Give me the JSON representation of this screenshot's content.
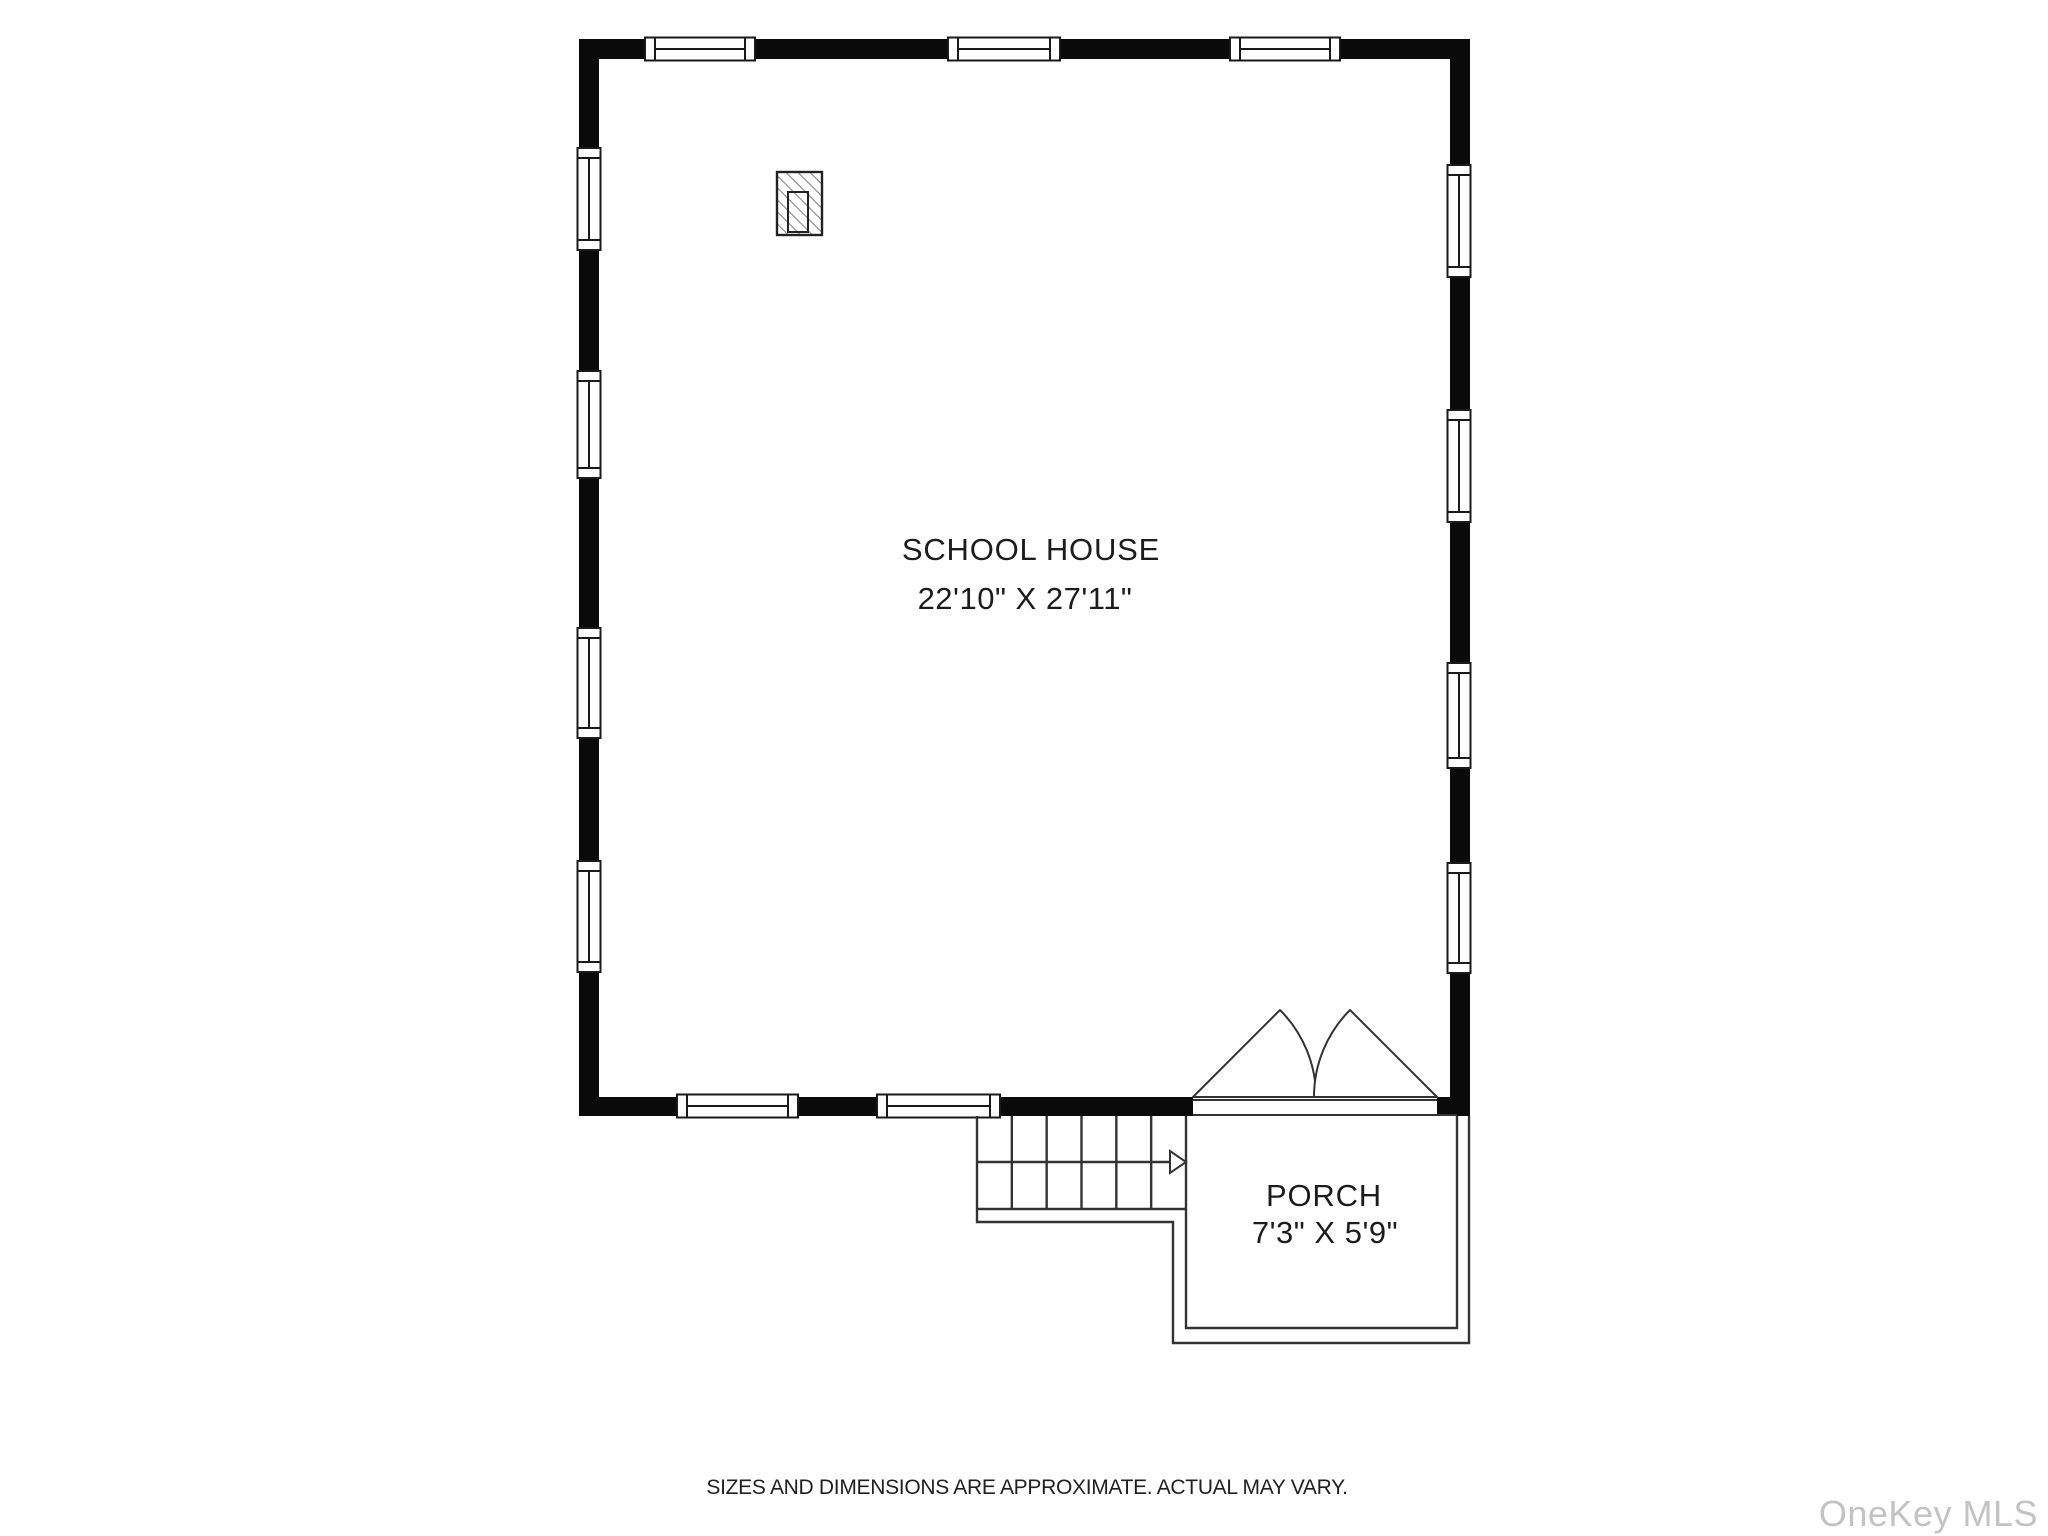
{
  "page": {
    "room": {
      "label": "SCHOOL HOUSE",
      "dimensions": "22'10\" X 27'11\""
    },
    "porch": {
      "label": "PORCH",
      "dimensions": "7'3\" X 5'9\""
    },
    "footer": {
      "disclaimer": "SIZES AND DIMENSIONS ARE APPROXIMATE. ACTUAL MAY VARY."
    },
    "watermark": "OneKey MLS",
    "colors": {
      "background": "#ffffff",
      "wall": "#0a0a0a",
      "line": "#333333",
      "text": "#1c1c1c",
      "watermark": "#c3c3c3"
    }
  }
}
